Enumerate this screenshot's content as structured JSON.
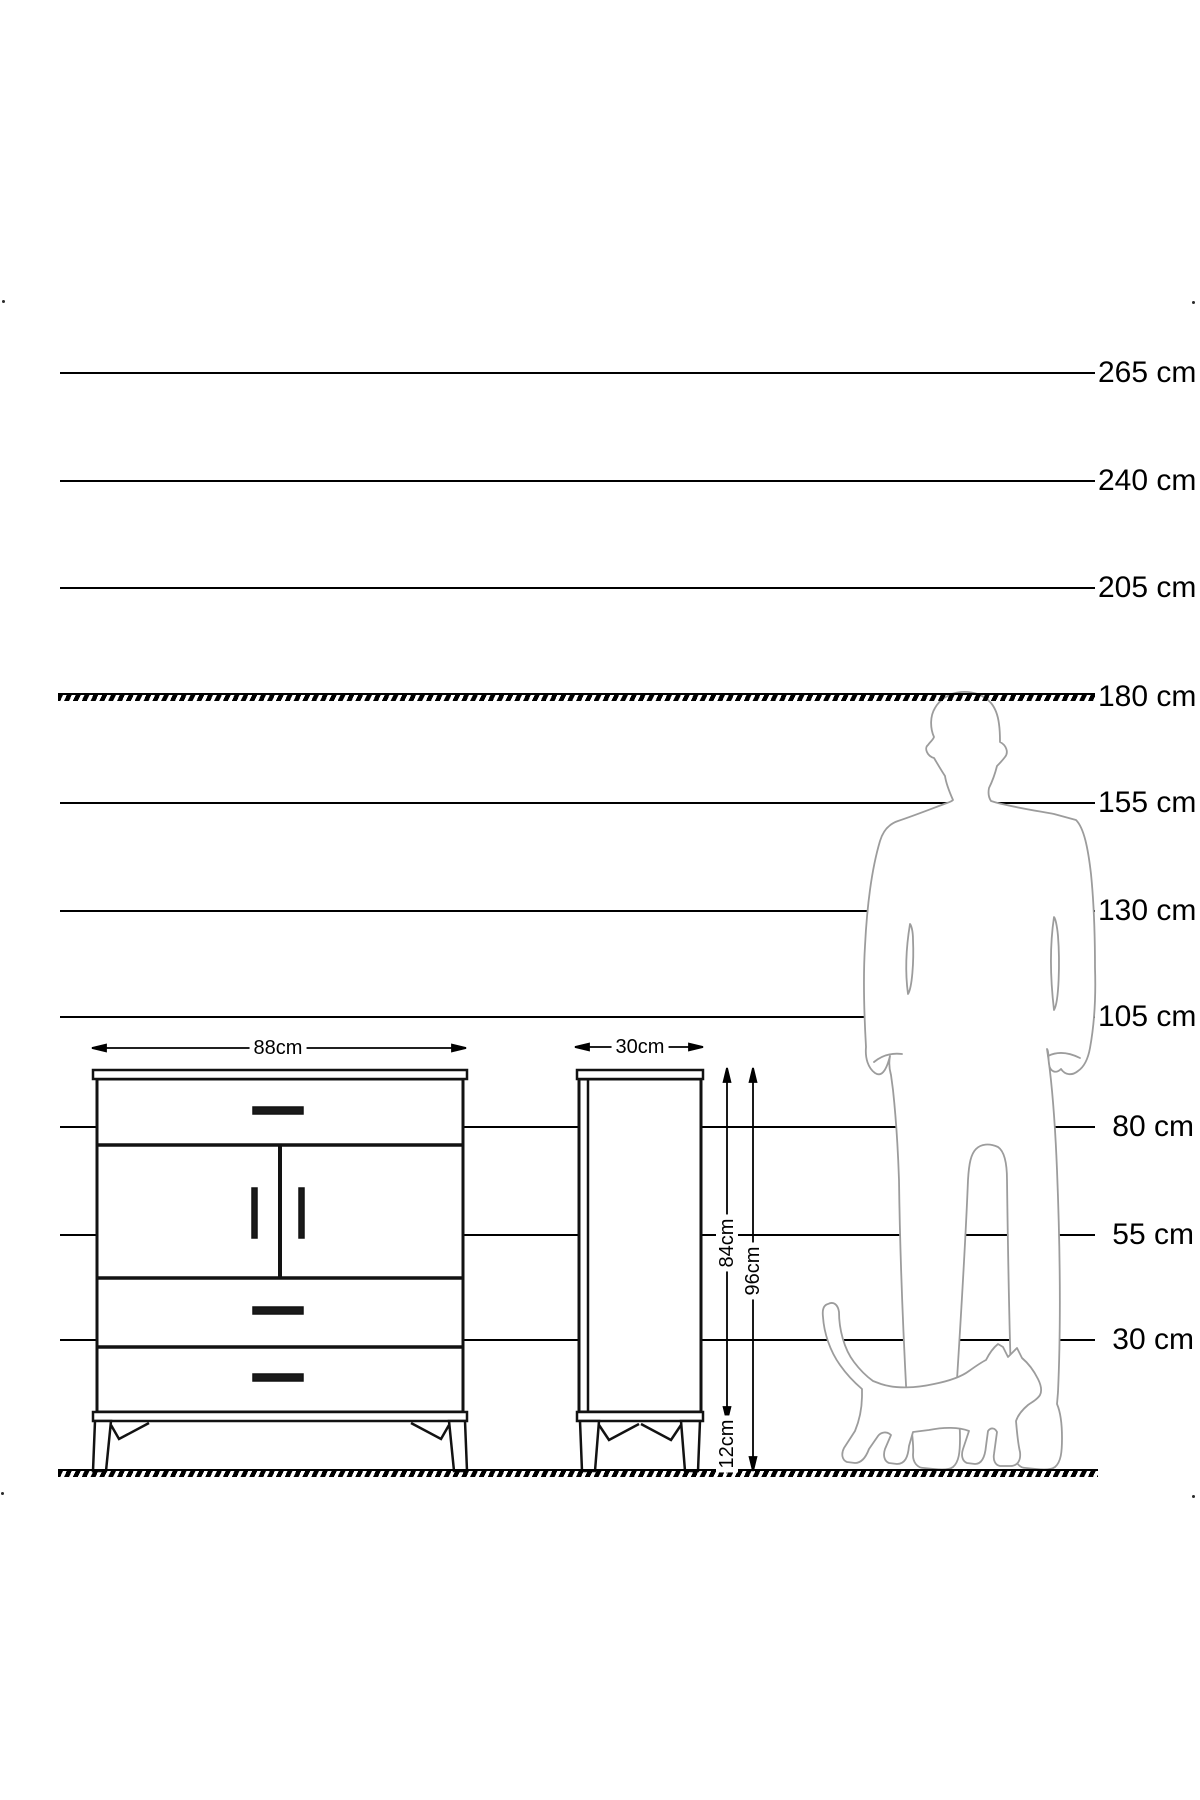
{
  "diagram": {
    "unit": "cm",
    "height_scale": {
      "labels": [
        "265 cm",
        "240 cm",
        "205 cm",
        "180 cm",
        "155 cm",
        "130 cm",
        "105 cm",
        "80 cm",
        "55 cm",
        "30 cm"
      ],
      "dashed_line_label": "180 cm"
    },
    "front_view": {
      "width_label": "88cm",
      "drawers": 3,
      "doors": 2
    },
    "side_view": {
      "width_label": "30cm",
      "body_height_label": "84cm",
      "total_height_label": "96cm",
      "leg_height_label": "12cm"
    },
    "colors": {
      "line": "#000000",
      "figure_outline": "#9c9c9c",
      "background": "#ffffff"
    }
  }
}
